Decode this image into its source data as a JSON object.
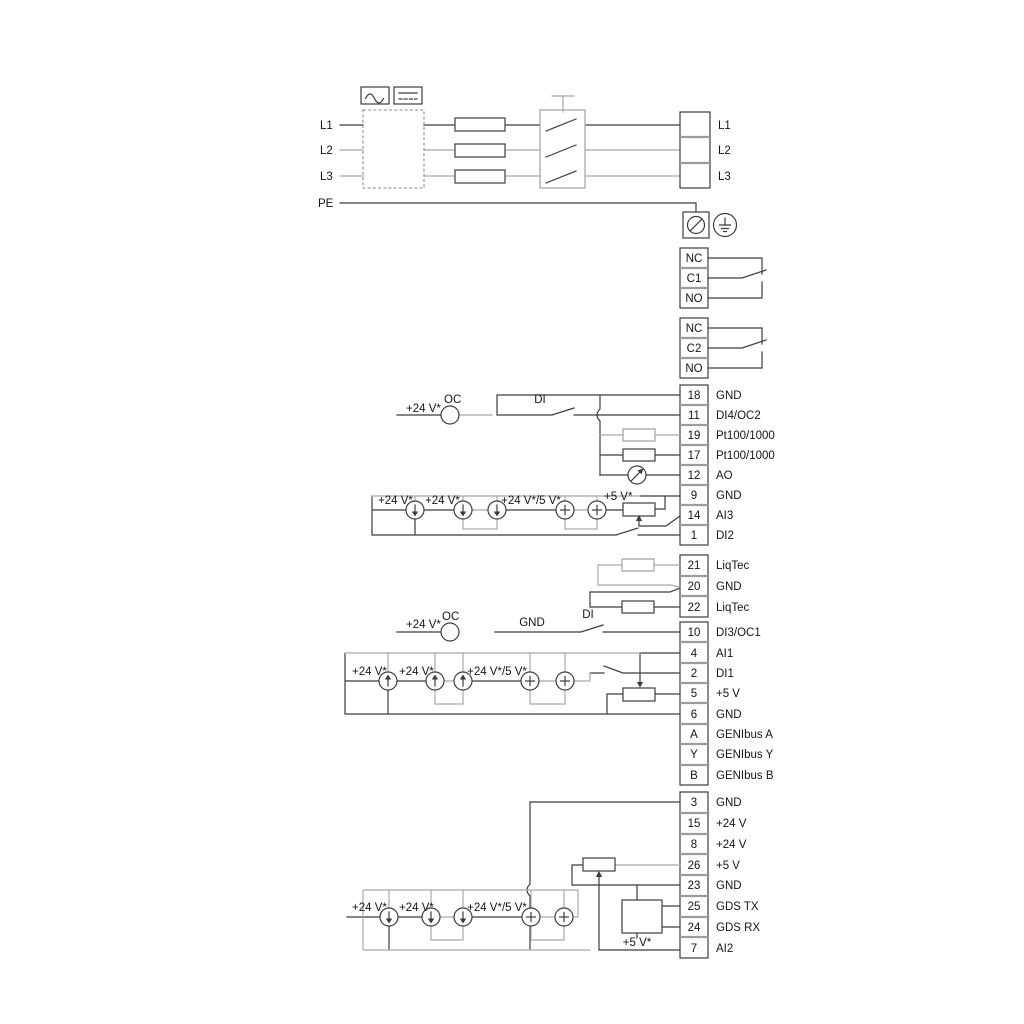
{
  "labels": {
    "v24": "+24 V*",
    "v24_5": "+24 V*/5 V*",
    "v5": "+5 V*",
    "oc": "OC",
    "di": "DI",
    "gnd": "GND"
  },
  "power": {
    "in": [
      "L1",
      "L2",
      "L3",
      "PE"
    ],
    "out": [
      "L1",
      "L2",
      "L3"
    ]
  },
  "relays": {
    "r1": [
      "NC",
      "C1",
      "NO"
    ],
    "r2": [
      "NC",
      "C2",
      "NO"
    ]
  },
  "strips": {
    "s1": [
      {
        "num": "18",
        "label": "GND"
      },
      {
        "num": "11",
        "label": "DI4/OC2"
      },
      {
        "num": "19",
        "label": "Pt100/1000"
      },
      {
        "num": "17",
        "label": "Pt100/1000"
      },
      {
        "num": "12",
        "label": "AO"
      },
      {
        "num": "9",
        "label": "GND"
      },
      {
        "num": "14",
        "label": "AI3"
      },
      {
        "num": "1",
        "label": "DI2"
      }
    ],
    "liqtec": [
      {
        "num": "21",
        "label": "LiqTec"
      },
      {
        "num": "20",
        "label": "GND"
      },
      {
        "num": "22",
        "label": "LiqTec"
      }
    ],
    "s2": [
      {
        "num": "10",
        "label": "DI3/OC1"
      },
      {
        "num": "4",
        "label": "AI1"
      },
      {
        "num": "2",
        "label": "DI1"
      },
      {
        "num": "5",
        "label": "+5 V"
      },
      {
        "num": "6",
        "label": "GND"
      },
      {
        "num": "A",
        "label": "GENIbus A"
      },
      {
        "num": "Y",
        "label": "GENIbus Y"
      },
      {
        "num": "B",
        "label": "GENIbus B"
      }
    ],
    "s3": [
      {
        "num": "3",
        "label": "GND"
      },
      {
        "num": "15",
        "label": "+24 V"
      },
      {
        "num": "8",
        "label": "+24 V"
      },
      {
        "num": "26",
        "label": "+5 V"
      },
      {
        "num": "23",
        "label": "GND"
      },
      {
        "num": "25",
        "label": "GDS TX"
      },
      {
        "num": "24",
        "label": "GDS RX"
      },
      {
        "num": "7",
        "label": "AI2"
      }
    ]
  },
  "colors": {
    "wire": "#3c3c3c",
    "wire_alt": "#a9a9a9",
    "text": "#151515"
  }
}
